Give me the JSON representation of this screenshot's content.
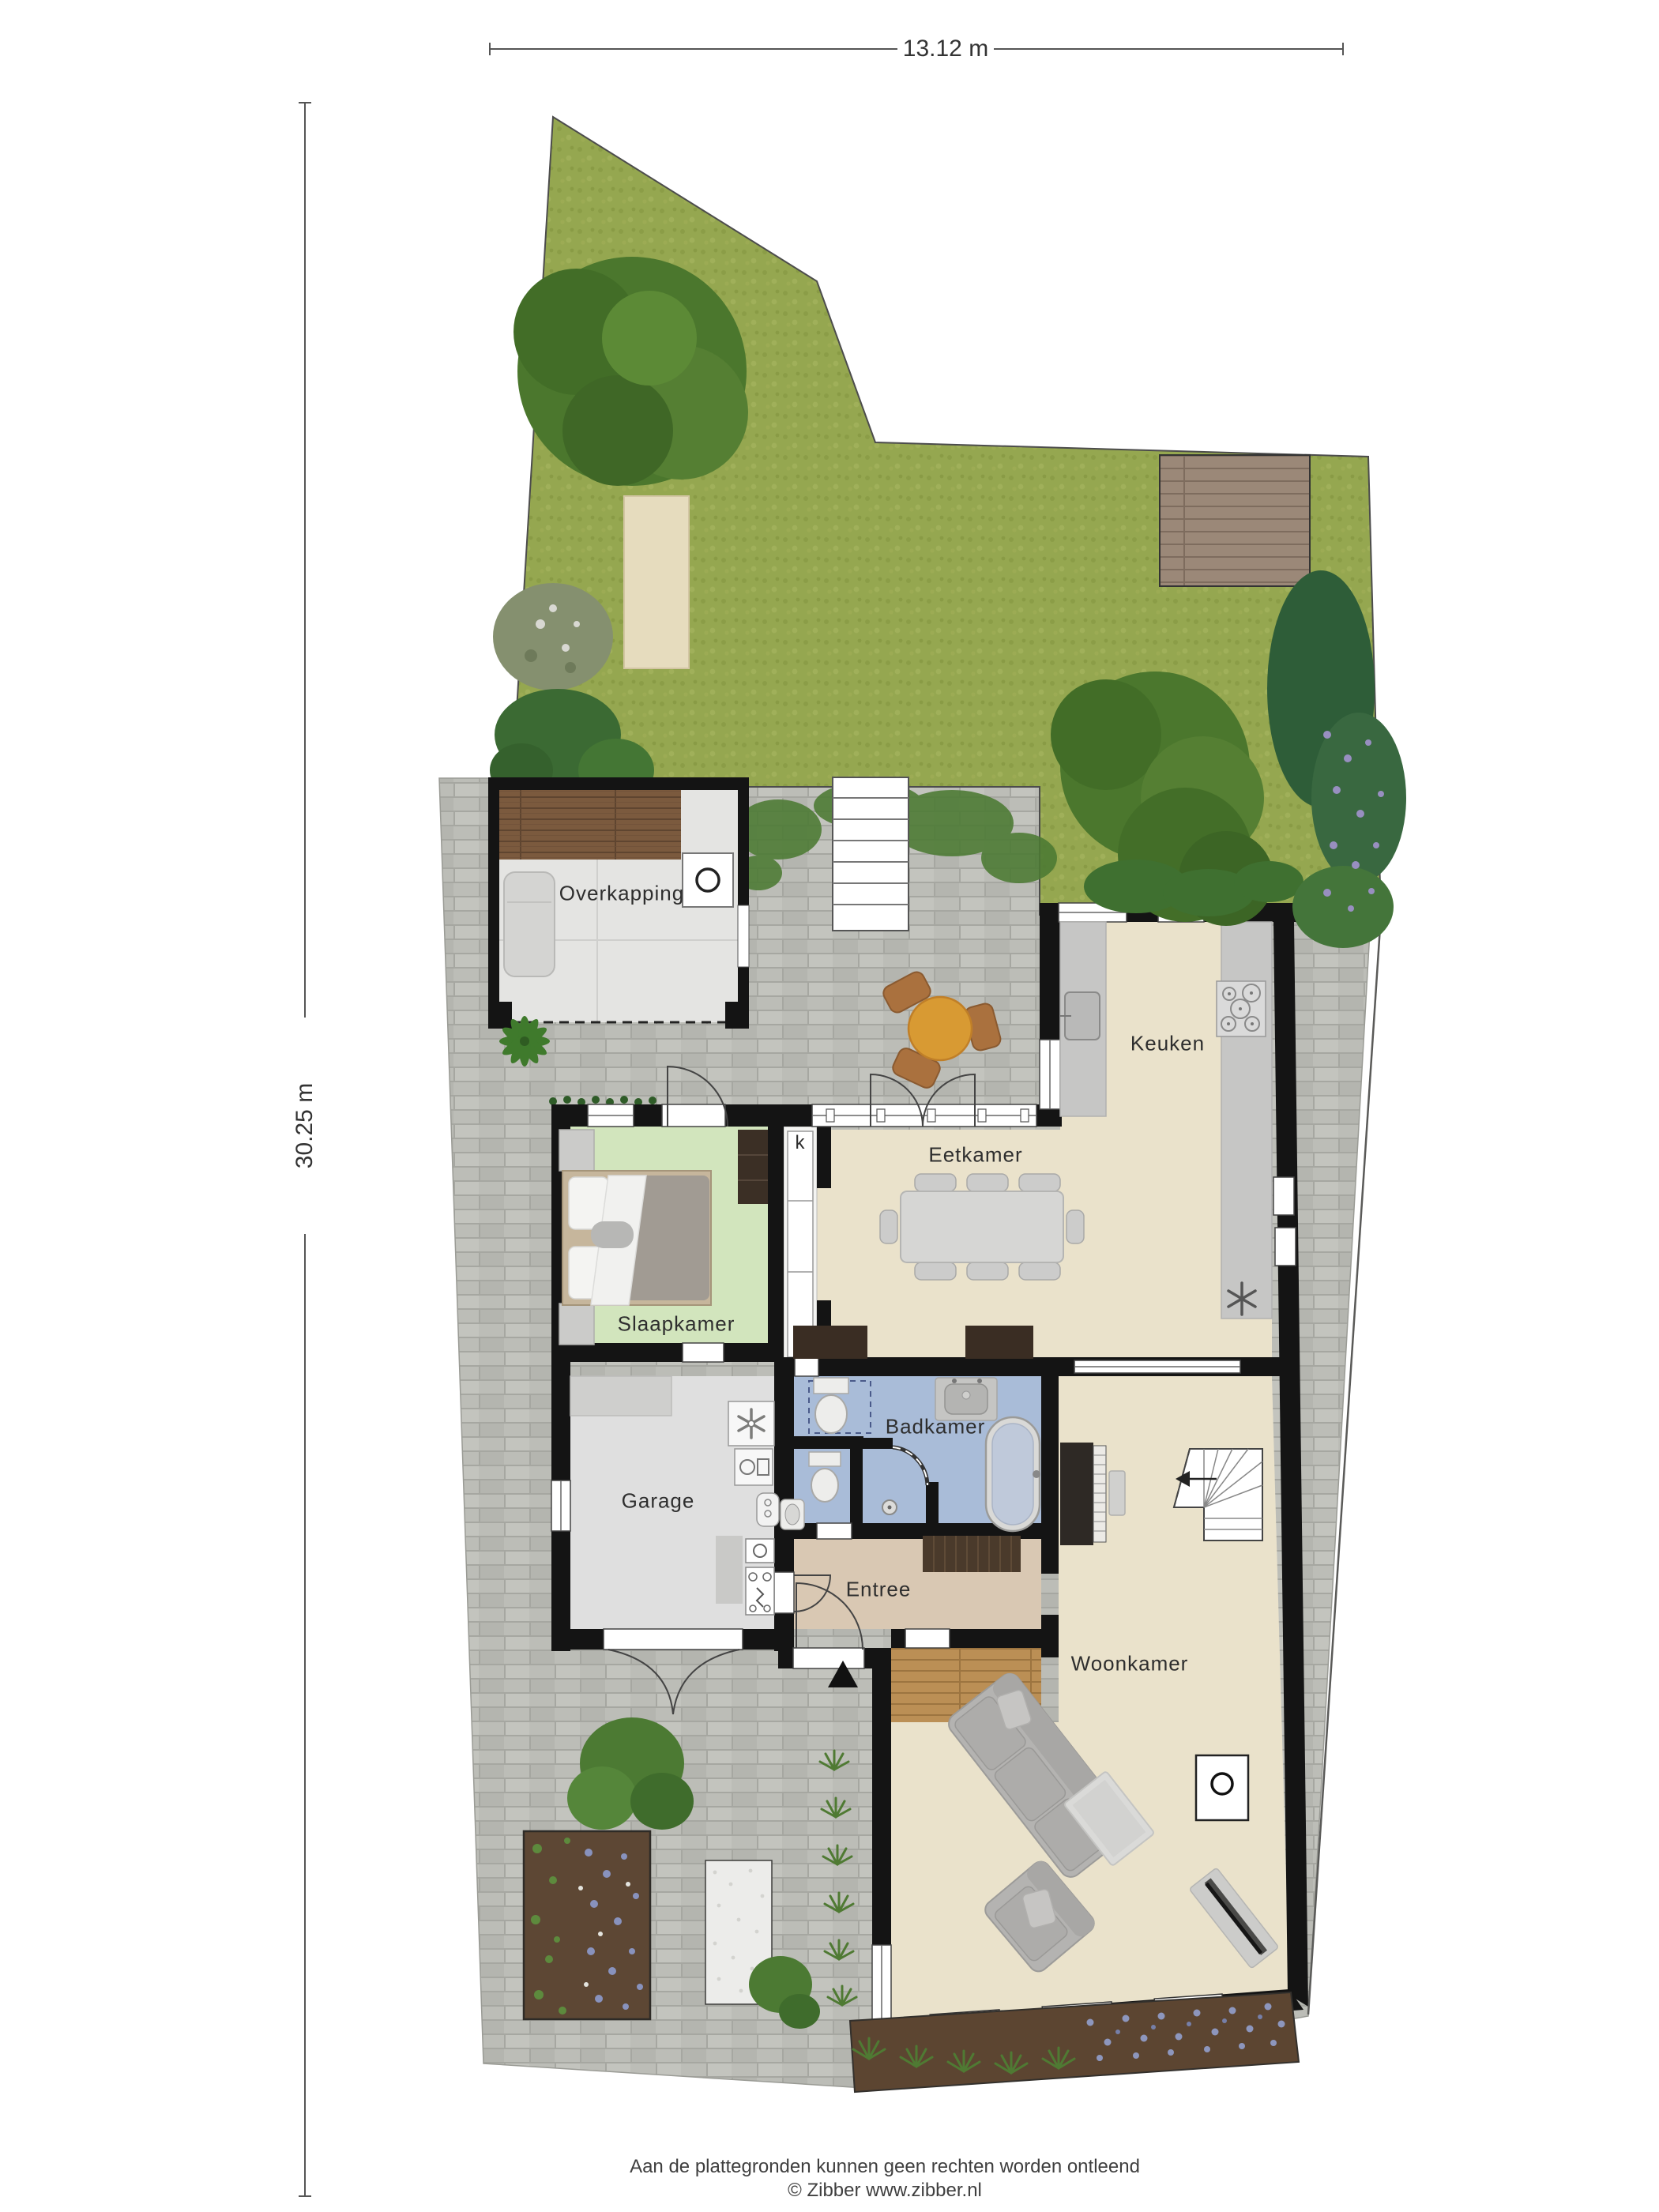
{
  "dimension_labels": {
    "width": "13.12 m",
    "height": "30.25 m"
  },
  "room_labels": {
    "overkapping": "Overkapping",
    "keuken": "Keuken",
    "eetkamer": "Eetkamer",
    "slaapkamer": "Slaapkamer",
    "badkamer": "Badkamer",
    "garage": "Garage",
    "entree": "Entree",
    "woonkamer": "Woonkamer",
    "closet_k": "k"
  },
  "footer": {
    "disclaimer": "Aan de plattegronden kunnen geen rechten worden ontleend",
    "copyright": "© Zibber www.zibber.nl"
  },
  "colors": {
    "grass": "#95a750",
    "paver": "#bcbdb7",
    "wall": "#141414",
    "floor_living": "#eae2cb",
    "floor_bedroom": "#d2e5bd",
    "floor_bath": "#a9bcd8",
    "floor_garage": "#dfdfdf",
    "floor_entree": "#d9c8b3",
    "deck_wood": "#7b5a3e",
    "garden_deck": "#9b8878",
    "hall_wood": "#bb8f55",
    "patio_table": "#d89a33",
    "soil": "#5d4734",
    "lavender": "#8d96bd",
    "shrub": "#4c7a33",
    "tree": "#4b772d"
  },
  "icons": {
    "entrance_marker": "triangle-up",
    "freezer": "six-spoke-asterisk",
    "ventilation": "fan-blades",
    "stove": "gas-hob-burners",
    "stair_direction": "arrow-left"
  }
}
